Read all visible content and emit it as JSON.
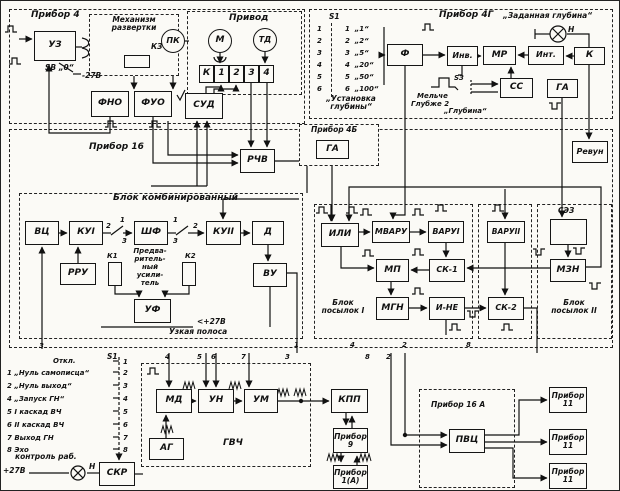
{
  "device4": {
    "title": "Прибор 4",
    "uz": "УЗ",
    "sweep_line1": "Механизм",
    "sweep_line2": "развертки",
    "kz": "КЗ",
    "sb": "SВ „0“",
    "minus27": "-27В",
    "fno": "ФНО",
    "fuo": "ФУО",
    "pk": "ПК",
    "drive": "Привод",
    "m": "М",
    "td": "ТД",
    "terminals": [
      "К",
      "1",
      "2",
      "3",
      "4"
    ],
    "sud": "СУД"
  },
  "device4g": {
    "title": "Прибор 4Г",
    "s1": "S1",
    "rows": [
      {
        "i": "1",
        "v": "„1“"
      },
      {
        "i": "2",
        "v": "„2“"
      },
      {
        "i": "3",
        "v": "„5“"
      },
      {
        "i": "4",
        "v": "„20“"
      },
      {
        "i": "5",
        "v": "„50“"
      },
      {
        "i": "6",
        "v": "„100“"
      }
    ],
    "depth_set_1": "„Установка",
    "depth_set_2": "глубины“",
    "f": "Ф",
    "inv": "Инв.",
    "mr": "МР",
    "int": "Инт.",
    "k": "К",
    "lamp": "„Заданная глубина“",
    "n": "Н",
    "melche": "Мельче",
    "glubzhe": "Глубже 2",
    "s3": "S3",
    "glubina": "„Глубина“",
    "ss": "СС",
    "ga": "ГА"
  },
  "revun": {
    "label": "Ревун"
  },
  "device4b": {
    "title": "Прибор 4Б",
    "ga": "ГА"
  },
  "device16": {
    "title": "Прибор 16",
    "rchv": "РЧВ"
  },
  "combined": {
    "title": "Блок комбинированный",
    "vc": "ВЦ",
    "ku1": "КУI",
    "shf": "ШФ",
    "ku2": "КУII",
    "d": "Д",
    "rru": "РРУ",
    "k1": "К1",
    "k2": "К2",
    "preamp": [
      "Предва-",
      "ритель-",
      "ный",
      "усили-",
      "тель"
    ],
    "uf": "УФ",
    "vu": "ВУ",
    "narrow": "Узкая полоса",
    "plus27": "+27В"
  },
  "burst1": {
    "title1": "Блок",
    "title2": "посылок I",
    "ili": "ИЛИ",
    "mvaru": "МВАРУ",
    "varu1": "ВАРУI",
    "mp": "МП",
    "sk1": "СК-1",
    "mgn": "МГН",
    "ine": "И-НЕ"
  },
  "midblocks": {
    "varu2": "ВАРУII",
    "sk2": "СК-2"
  },
  "burst2": {
    "title1": "Блок",
    "title2": "посылок II",
    "sez": "СЭЗ",
    "mzn": "МЗН"
  },
  "control": {
    "s1": "S1",
    "otkl": "Откл.",
    "otkl_r": "1",
    "rows": [
      {
        "l": "1",
        "t": "„Нуль самописца“",
        "r": "2"
      },
      {
        "l": "2",
        "t": "„Нуль выход“",
        "r": "3"
      },
      {
        "l": "4",
        "t": "„Запуск ГН“",
        "r": "4"
      },
      {
        "l": "5",
        "t": "I каскад ВЧ",
        "r": "5"
      },
      {
        "l": "6",
        "t": "II каскад ВЧ",
        "r": "6"
      },
      {
        "l": "7",
        "t": "Выход ГН",
        "r": "7"
      },
      {
        "l": "8",
        "t": "Эхо",
        "r": "8"
      }
    ],
    "kontrol": "контроль раб.",
    "plus27": "+27В",
    "n": "Н",
    "skr": "СКР"
  },
  "gvch": {
    "title": "ГВЧ",
    "md": "МД",
    "un": "УН",
    "um": "УМ",
    "ag": "АГ"
  },
  "bottom": {
    "kpp": "КПП",
    "d9_1": "Прибор",
    "d9_2": "9",
    "d1a_1": "Прибор",
    "d1a_2": "1(А)",
    "d16a": "Прибор 16 А",
    "pvc": "ПВЦ",
    "d11_1": "Прибор",
    "d11_2": "11"
  },
  "terminals": [
    "3",
    "1",
    "4",
    "2",
    "8",
    "4",
    "5",
    "6",
    "7",
    "3",
    "8",
    "2"
  ],
  "contact_nums": [
    "2",
    "1",
    "3",
    "1",
    "3",
    "2"
  ]
}
